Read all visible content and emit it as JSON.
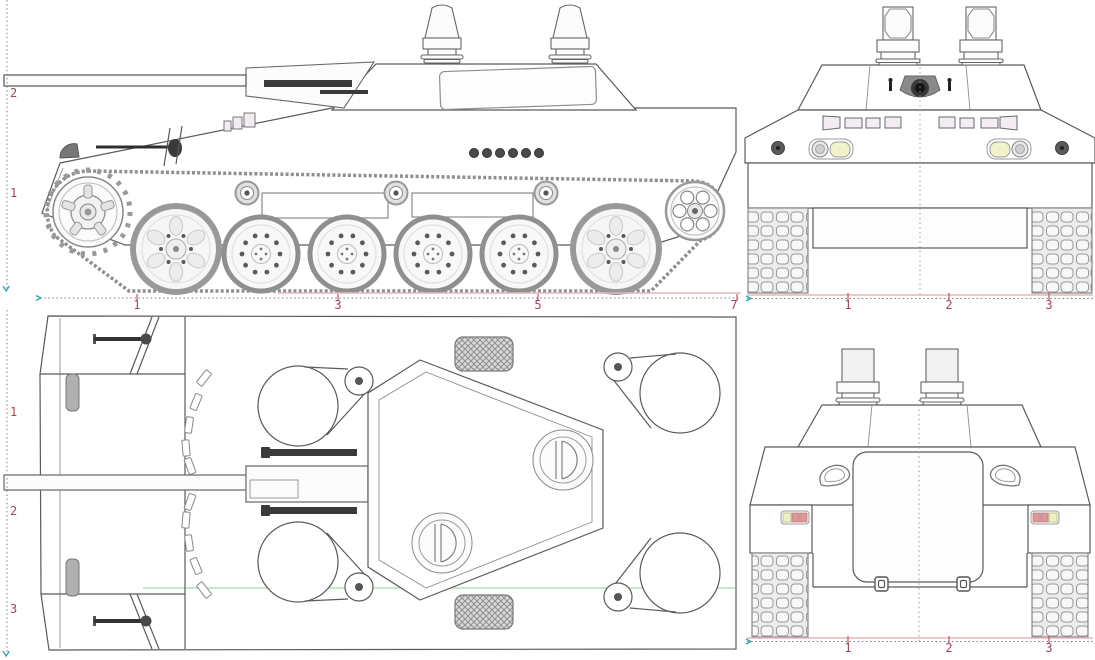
{
  "blueprint": {
    "background": "#ffffff",
    "line_color": "#5a5a5a",
    "views": {
      "side": "side-elevation",
      "front": "front-elevation",
      "top": "plan-view",
      "rear": "rear-elevation"
    },
    "rulers": {
      "side_vertical": [
        "2",
        "1"
      ],
      "side_horizontal": [
        "1",
        "3",
        "5",
        "7"
      ],
      "front_horizontal": [
        "1",
        "2",
        "3"
      ],
      "top_vertical": [
        "1",
        "2",
        "3"
      ],
      "rear_horizontal": [
        "1",
        "2",
        "3"
      ]
    },
    "colors": {
      "ruler_number": "#a24550",
      "ruler_tick": "#c05560",
      "ruler_baseline_pink": "#e4b6bc",
      "ruler_dotted": "#7a7a94",
      "vertical_ruler_dotted": "#9a7080",
      "origin_arrow_teal": "#2fa8a8",
      "guide_line_green": "#b5dfb5",
      "headlight_lens": "#f2f2c9",
      "taillight_yellow": "#eeeebe",
      "taillight_red": "#dc9898",
      "periscope_tint": "#f3ecf2",
      "dark_fitting": "#3a3a3a",
      "track_gray": "#8f8f8f"
    }
  }
}
